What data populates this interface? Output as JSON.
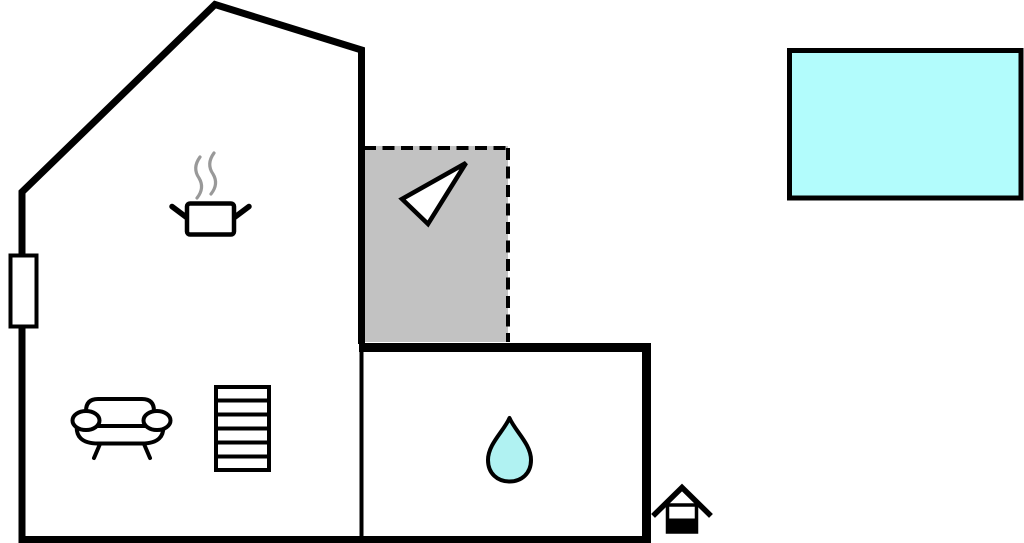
{
  "scene": {
    "type": "floor-plan",
    "background": "#ffffff"
  },
  "colors": {
    "outline": "#000000",
    "terrace_fill": "#c2c2c2",
    "pool_fill": "#b2fcfc",
    "water_drop_fill": "#b0f2f2",
    "steam_stroke": "#999999",
    "white_fill": "#ffffff"
  },
  "icons": [
    {
      "name": "window-marker"
    },
    {
      "name": "cooking-pot-icon"
    },
    {
      "name": "steam-icon"
    },
    {
      "name": "direction-arrow-icon"
    },
    {
      "name": "sofa-icon"
    },
    {
      "name": "stairs-icon"
    },
    {
      "name": "water-drop-icon"
    },
    {
      "name": "annex-house-icon"
    },
    {
      "name": "swimming-pool"
    }
  ]
}
